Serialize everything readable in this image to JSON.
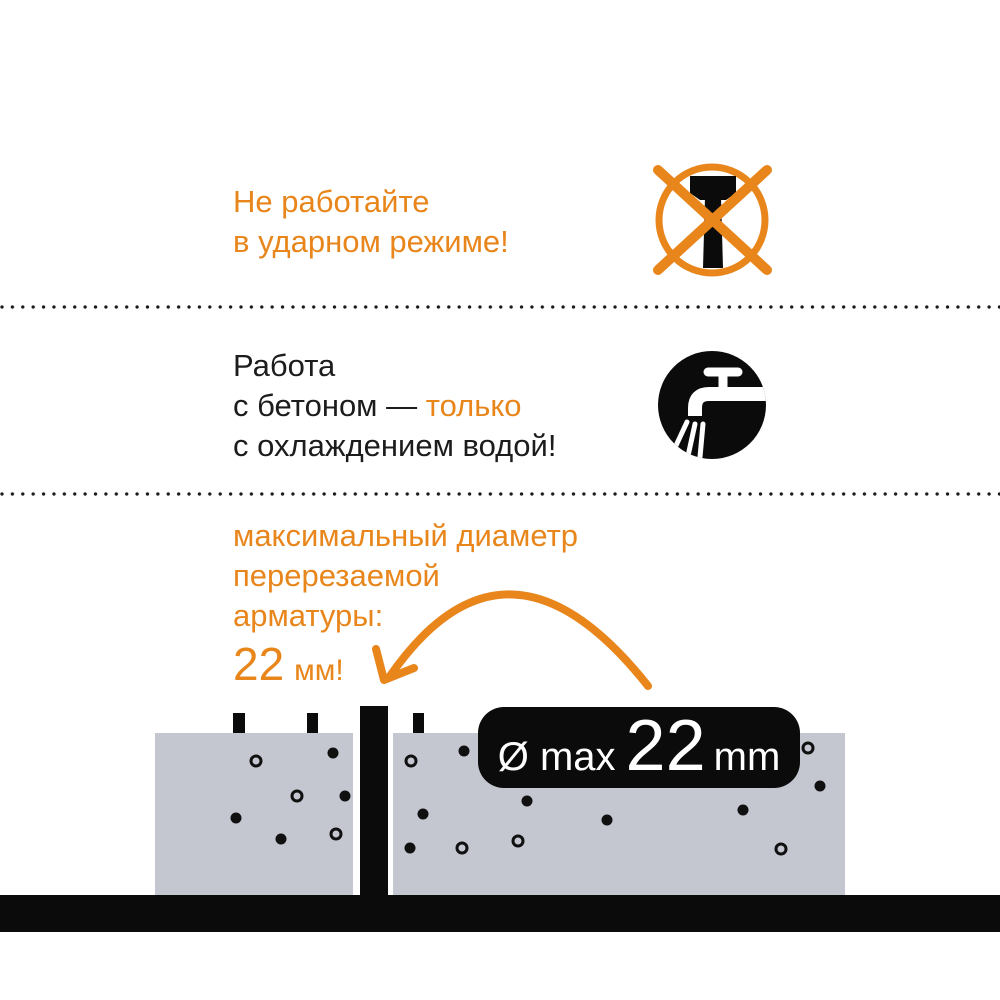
{
  "colors": {
    "orange": "#E8861C",
    "ink": "#1C1C1C",
    "black": "#0B0B0B",
    "concrete": "#C4C6D0",
    "badge_text": "#FFFFFF"
  },
  "section_no_impact": {
    "line1": "Не работайте",
    "line2": "в ударном режиме!",
    "icon": "no-hammer-icon"
  },
  "section_water": {
    "line1": "Работа",
    "line2_prefix": "с бетоном — ",
    "line2_highlight": "только",
    "line3": "с охлаждением водой!",
    "icon": "water-cooling-faucet-icon"
  },
  "section_rebar": {
    "line1": "максимальный диаметр",
    "line2": "перерезаемой",
    "line3": "арматуры:",
    "value": "22",
    "unit": "мм!",
    "icon": "curved-arrow-icon"
  },
  "badge": {
    "prefix": "Ø max",
    "value": "22",
    "unit": "mm"
  },
  "diagram": {
    "rebar_stubs": [
      {
        "x": 233,
        "w": 12
      },
      {
        "x": 307,
        "w": 11
      },
      {
        "x": 413,
        "w": 11
      }
    ],
    "filled_dots": [
      [
        333,
        753
      ],
      [
        236,
        818
      ],
      [
        345,
        796
      ],
      [
        281,
        839
      ],
      [
        464,
        751
      ],
      [
        423,
        814
      ],
      [
        410,
        848
      ],
      [
        527,
        801
      ],
      [
        607,
        820
      ],
      [
        743,
        810
      ],
      [
        820,
        786
      ]
    ],
    "open_dots": [
      [
        256,
        761
      ],
      [
        297,
        796
      ],
      [
        336,
        834
      ],
      [
        411,
        761
      ],
      [
        462,
        848
      ],
      [
        518,
        841
      ],
      [
        781,
        849
      ],
      [
        808,
        748
      ]
    ]
  }
}
